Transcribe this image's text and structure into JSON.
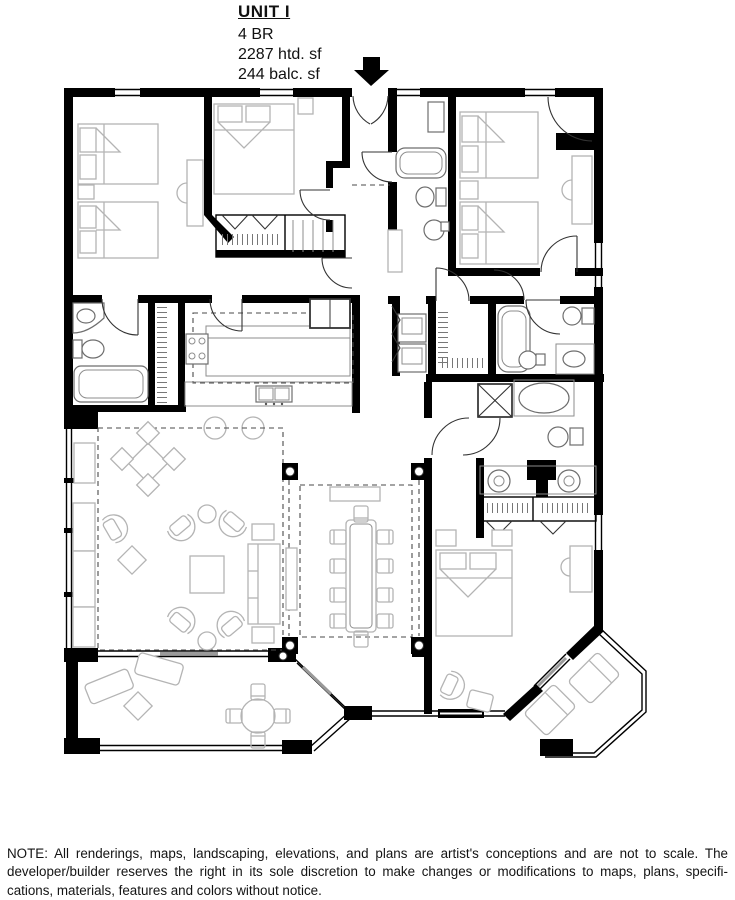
{
  "unit": {
    "name": "UNIT I",
    "bedrooms": "4 BR",
    "heated_area": "2287 htd. sf",
    "balcony_area": "244 balc. sf"
  },
  "entry": {
    "arrow_icon": "down-arrow"
  },
  "disclaimer": {
    "lines": [
      "NOTE: All renderings, maps, landscaping, elevations, and plans are artist's conceptions and are not to scale. The",
      "developer/builder reserves the right in its sole discretion to make changes or modifications to maps, plans, specifi-",
      "cations, materials, features and colors without notice."
    ]
  },
  "colors": {
    "wall": "#000000",
    "furniture": "#b4b4b4",
    "fixture": "#6e6e6e",
    "dash": "#4a4a4a",
    "accent_gray": "#9a9a9a",
    "background": "#ffffff",
    "text": "#111111"
  }
}
